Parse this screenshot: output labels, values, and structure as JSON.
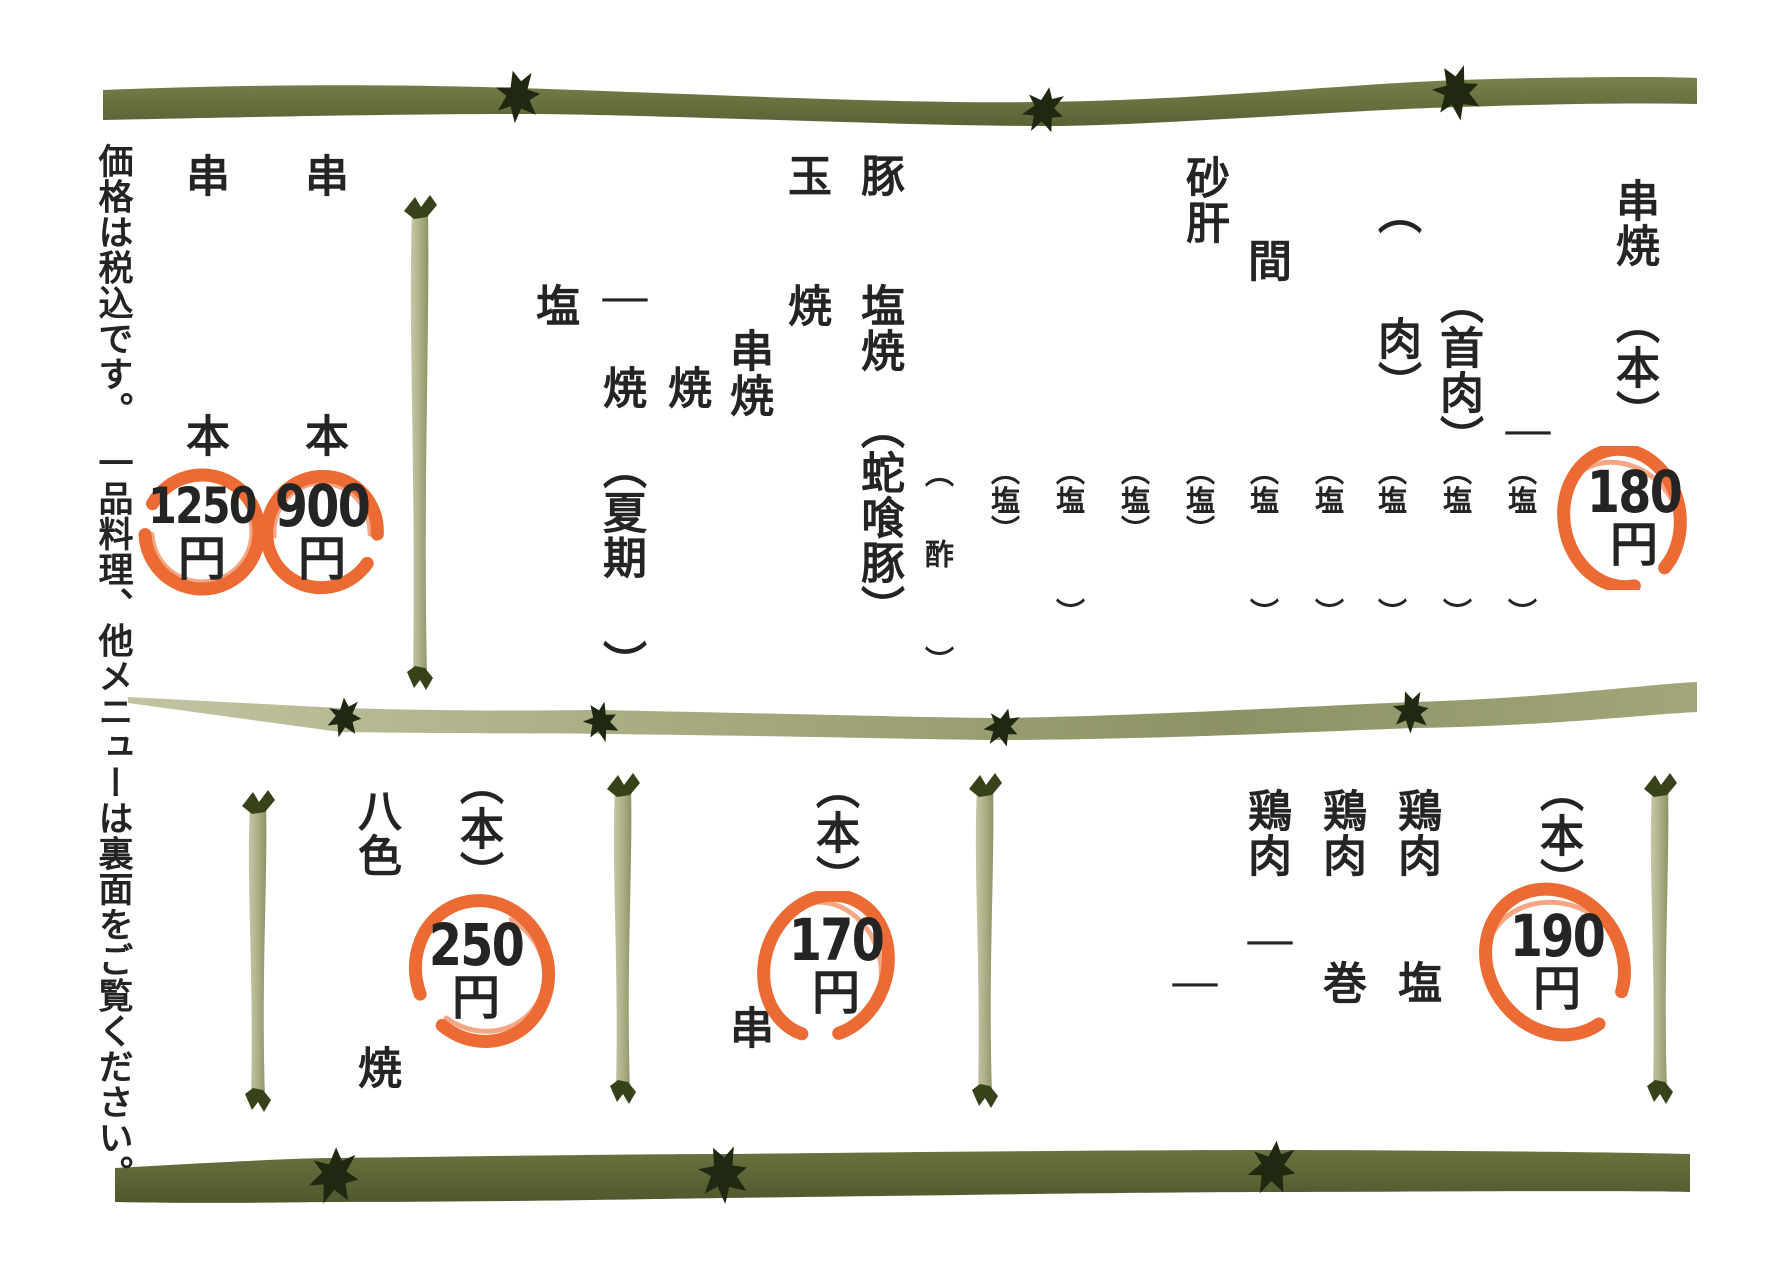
{
  "page": {
    "background": "#ffffff",
    "ink": "#242424",
    "stamp_color": "#ec6a33",
    "bamboo_dark": "#68713d",
    "bamboo_light": "#aeb189",
    "bamboo_knot": "#1f2911",
    "stick_tip": "#36431a"
  },
  "notice": {
    "text": "価格は税込です。　一品料理、他メニューは裏面をご覧ください。"
  },
  "top_section": {
    "runs": [
      {
        "x": 203,
        "y": 153,
        "size": 44,
        "text": "串",
        "name": "item-kushi-1"
      },
      {
        "x": 203,
        "y": 413,
        "size": 44,
        "text": "本",
        "name": "unit-hon-1"
      },
      {
        "x": 322,
        "y": 153,
        "size": 44,
        "text": "串",
        "name": "item-kushi-2"
      },
      {
        "x": 322,
        "y": 413,
        "size": 44,
        "text": "本",
        "name": "unit-hon-2"
      },
      {
        "x": 553,
        "y": 283,
        "size": 44,
        "text": "塩",
        "name": "item-shio"
      },
      {
        "x": 620,
        "y": 278,
        "size": 44,
        "text": "ー",
        "name": "item-dash"
      },
      {
        "x": 620,
        "y": 365,
        "size": 44,
        "text": "焼",
        "name": "item-yaki-natsuki"
      },
      {
        "x": 620,
        "y": 445,
        "size": 44,
        "text": "（夏期",
        "name": "note-kaki-open"
      },
      {
        "x": 620,
        "y": 640,
        "size": 44,
        "text": "）",
        "name": "note-kaki-close"
      },
      {
        "x": 685,
        "y": 365,
        "size": 44,
        "text": "焼",
        "name": "item-yaki"
      },
      {
        "x": 747,
        "y": 328,
        "size": 44,
        "text": "串焼",
        "name": "item-kushiyaki"
      },
      {
        "x": 805,
        "y": 153,
        "size": 44,
        "text": "玉",
        "name": "item-tama"
      },
      {
        "x": 805,
        "y": 283,
        "size": 44,
        "text": "焼",
        "name": "item-tama-yaki"
      },
      {
        "x": 878,
        "y": 153,
        "size": 44,
        "text": "豚",
        "name": "item-buta"
      },
      {
        "x": 878,
        "y": 283,
        "size": 44,
        "text": "塩焼",
        "name": "item-buta-shioyaki"
      },
      {
        "x": 878,
        "y": 405,
        "size": 44,
        "text": "（蛇喰豚）",
        "name": "note-jakuributa"
      },
      {
        "x": 937,
        "y": 458,
        "size": 29,
        "text": "（",
        "name": "note-su-open"
      },
      {
        "x": 937,
        "y": 539,
        "size": 29,
        "text": "酢",
        "name": "note-su"
      },
      {
        "x": 937,
        "y": 646,
        "size": 29,
        "text": "）",
        "name": "note-su-close"
      },
      {
        "x": 1003,
        "y": 456,
        "size": 29,
        "text": "（塩）",
        "name": "note-shio-1"
      },
      {
        "x": 1068,
        "y": 456,
        "size": 29,
        "text": "（塩",
        "name": "note-shio-2"
      },
      {
        "x": 1068,
        "y": 598,
        "size": 29,
        "text": "）",
        "name": "note-shio-2-close"
      },
      {
        "x": 1133,
        "y": 456,
        "size": 29,
        "text": "（塩）",
        "name": "note-shio-3"
      },
      {
        "x": 1198,
        "y": 456,
        "size": 29,
        "text": "（塩）",
        "name": "note-shio-4"
      },
      {
        "x": 1262,
        "y": 456,
        "size": 29,
        "text": "（塩",
        "name": "note-shio-5"
      },
      {
        "x": 1262,
        "y": 598,
        "size": 29,
        "text": "）",
        "name": "note-shio-5-close"
      },
      {
        "x": 1327,
        "y": 456,
        "size": 29,
        "text": "（塩",
        "name": "note-shio-6"
      },
      {
        "x": 1327,
        "y": 598,
        "size": 29,
        "text": "）",
        "name": "note-shio-6-close"
      },
      {
        "x": 1203,
        "y": 155,
        "size": 44,
        "text": "砂肝",
        "name": "item-sunagimo"
      },
      {
        "x": 1265,
        "y": 238,
        "size": 44,
        "text": "間",
        "name": "item-aida"
      },
      {
        "x": 1395,
        "y": 190,
        "size": 44,
        "text": "（",
        "name": "note-niku-open"
      },
      {
        "x": 1395,
        "y": 316,
        "size": 44,
        "text": "肉）",
        "name": "note-niku-close"
      },
      {
        "x": 1390,
        "y": 456,
        "size": 29,
        "text": "（塩",
        "name": "note-shio-7"
      },
      {
        "x": 1390,
        "y": 598,
        "size": 29,
        "text": "）",
        "name": "note-shio-7-close"
      },
      {
        "x": 1457,
        "y": 280,
        "size": 44,
        "text": "（首肉）",
        "name": "note-kubiniku"
      },
      {
        "x": 1455,
        "y": 456,
        "size": 29,
        "text": "（塩",
        "name": "note-shio-8"
      },
      {
        "x": 1455,
        "y": 598,
        "size": 29,
        "text": "）",
        "name": "note-shio-8-close"
      },
      {
        "x": 1523,
        "y": 411,
        "size": 44,
        "text": "ー",
        "name": "item-dash-2"
      },
      {
        "x": 1520,
        "y": 456,
        "size": 29,
        "text": "（塩",
        "name": "note-shio-9"
      },
      {
        "x": 1520,
        "y": 598,
        "size": 29,
        "text": "）",
        "name": "note-shio-9-close"
      },
      {
        "x": 1633,
        "y": 178,
        "size": 44,
        "text": "串焼",
        "name": "heading-kushiyaki"
      },
      {
        "x": 1633,
        "y": 300,
        "size": 44,
        "text": "（本）",
        "name": "heading-per-stick"
      }
    ]
  },
  "bottom_section": {
    "runs": [
      {
        "x": 375,
        "y": 788,
        "size": 44,
        "text": "八色",
        "name": "item-yairo"
      },
      {
        "x": 375,
        "y": 1045,
        "size": 44,
        "text": "焼",
        "name": "item-yairo-yaki"
      },
      {
        "x": 477,
        "y": 761,
        "size": 44,
        "text": "（本）",
        "name": "unit-per-stick-250"
      },
      {
        "x": 747,
        "y": 1005,
        "size": 44,
        "text": "串",
        "name": "item-kushi-170"
      },
      {
        "x": 833,
        "y": 765,
        "size": 44,
        "text": "（本）",
        "name": "unit-per-stick-170"
      },
      {
        "x": 1190,
        "y": 963,
        "size": 44,
        "text": "ー",
        "name": "item-dash-3"
      },
      {
        "x": 1265,
        "y": 788,
        "size": 44,
        "text": "鶏肉",
        "name": "item-toriniku-1"
      },
      {
        "x": 1265,
        "y": 921,
        "size": 44,
        "text": "ー",
        "name": "item-toriniku-1-dash"
      },
      {
        "x": 1340,
        "y": 788,
        "size": 44,
        "text": "鶏肉",
        "name": "item-toriniku-2"
      },
      {
        "x": 1340,
        "y": 960,
        "size": 44,
        "text": "巻",
        "name": "item-toriniku-maki"
      },
      {
        "x": 1415,
        "y": 788,
        "size": 44,
        "text": "鶏肉",
        "name": "item-toriniku-3"
      },
      {
        "x": 1415,
        "y": 960,
        "size": 44,
        "text": "塩",
        "name": "item-toriniku-shio"
      },
      {
        "x": 1557,
        "y": 768,
        "size": 44,
        "text": "（本）",
        "name": "unit-per-stick-190"
      }
    ]
  },
  "stamps": [
    {
      "value": "1250",
      "unit": "円",
      "cx": 202,
      "cy": 532,
      "rx": 57,
      "ry": 57,
      "gap": 210,
      "dx": 0
    },
    {
      "value": "900",
      "unit": "円",
      "cx": 322,
      "cy": 532,
      "rx": 55,
      "ry": 56,
      "gap": 35,
      "dx": 0
    },
    {
      "value": "180",
      "unit": "円",
      "cx": 1622,
      "cy": 518,
      "rx": 69,
      "ry": 58,
      "gap": 80,
      "dx": 12
    },
    {
      "value": "250",
      "unit": "円",
      "cx": 482,
      "cy": 971,
      "rx": 66,
      "ry": 71,
      "gap": 160,
      "dx": -6
    },
    {
      "value": "170",
      "unit": "円",
      "cx": 826,
      "cy": 966,
      "rx": 72,
      "ry": 61,
      "gap": 110,
      "dx": 10
    },
    {
      "value": "190",
      "unit": "円",
      "cx": 1555,
      "cy": 962,
      "rx": 76,
      "ry": 66,
      "gap": 55,
      "dx": 2
    }
  ]
}
